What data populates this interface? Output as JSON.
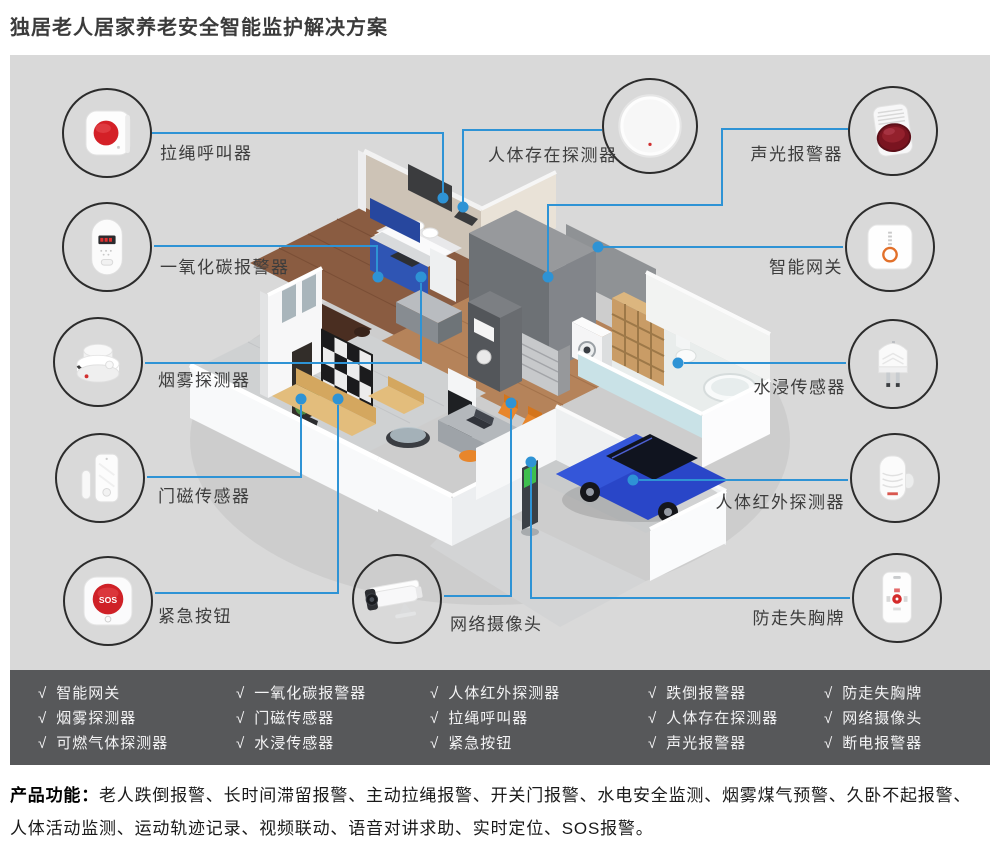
{
  "page": {
    "title": "独居老人居家养老安全智能监护解决方案"
  },
  "colors": {
    "accent_blue": "#2e93d5",
    "canvas_gray": "#d9d9d9",
    "bar_gray": "#57585a",
    "title_dark": "#3b3b3b",
    "alert_red": "#d42027",
    "gateway_orange": "#e2702a"
  },
  "devices": [
    {
      "id": "pull-cord-caller",
      "label": "拉绳呼叫器"
    },
    {
      "id": "co-alarm",
      "label": "一氧化碳报警器"
    },
    {
      "id": "smoke-detector",
      "label": "烟雾探测器"
    },
    {
      "id": "door-magnet-sensor",
      "label": "门磁传感器"
    },
    {
      "id": "emergency-button",
      "label": "紧急按钮",
      "sos": "SOS"
    },
    {
      "id": "presence-detector",
      "label": "人体存在探测器"
    },
    {
      "id": "network-camera",
      "label": "网络摄像头"
    },
    {
      "id": "sound-light-alarm",
      "label": "声光报警器"
    },
    {
      "id": "smart-gateway",
      "label": "智能网关"
    },
    {
      "id": "water-leak-sensor",
      "label": "水浸传感器"
    },
    {
      "id": "pir-detector",
      "label": "人体红外探测器"
    },
    {
      "id": "anti-loss-badge",
      "label": "防走失胸牌"
    }
  ],
  "product_list": {
    "check": "√",
    "columns": [
      [
        "智能网关",
        "烟雾探测器",
        "可燃气体探测器"
      ],
      [
        "一氧化碳报警器",
        "门磁传感器",
        "水浸传感器"
      ],
      [
        "人体红外探测器",
        "拉绳呼叫器",
        "紧急按钮"
      ],
      [
        "跌倒报警器",
        "人体存在探测器",
        "声光报警器"
      ],
      [
        "防走失胸牌",
        "网络摄像头",
        "断电报警器"
      ]
    ]
  },
  "features": {
    "heading": "产品功能：",
    "text": "老人跌倒报警、长时间滞留报警、主动拉绳报警、开关门报警、水电安全监测、烟雾煤气预警、久卧不起报警、人体活动监测、运动轨迹记录、视频联动、语音对讲求助、实时定位、SOS报警。"
  }
}
